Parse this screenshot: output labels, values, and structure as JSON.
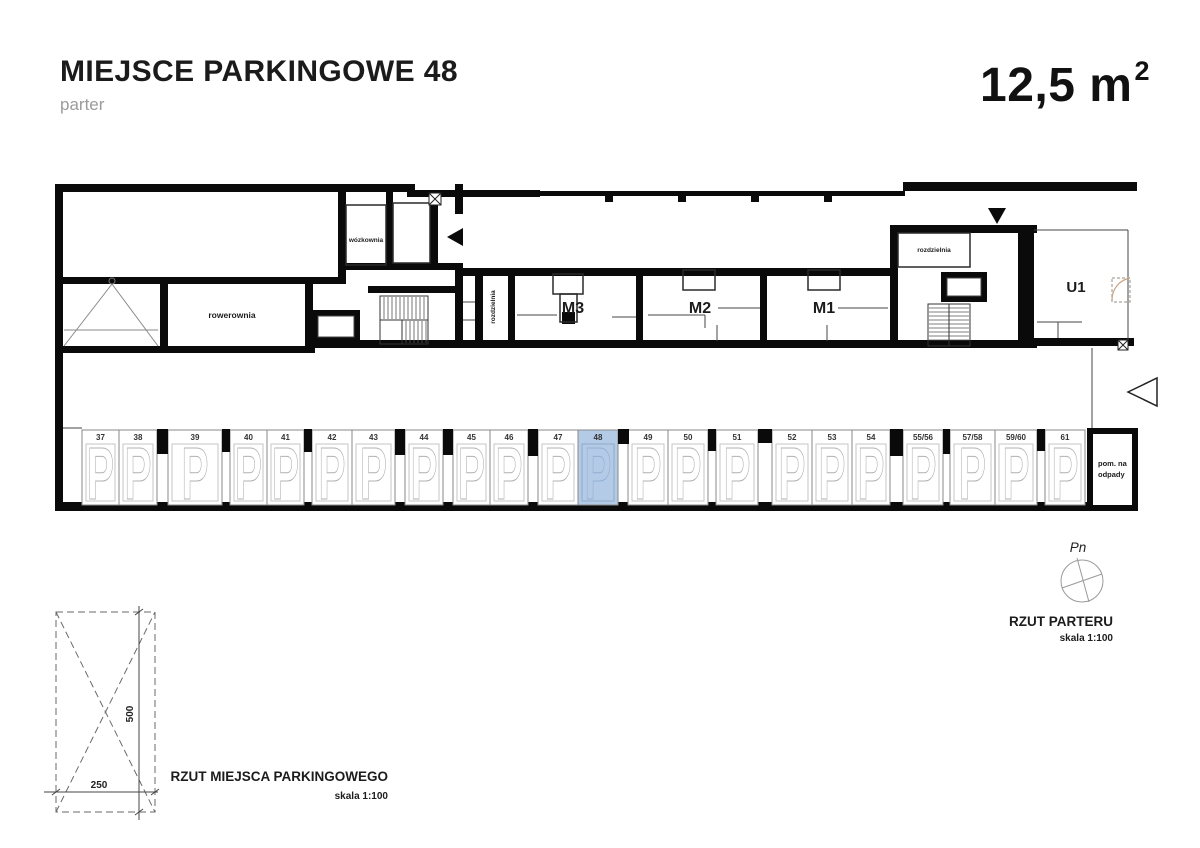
{
  "header": {
    "title": "MIEJSCE PARKINGOWE 48",
    "subtitle": "parter",
    "area": "12,5 m",
    "area_exponent": "2"
  },
  "plan": {
    "rooms": {
      "rowerownia": "rowerownia",
      "wozkownia": "wózkownia",
      "rozdzielnia_left": "rozdzielnia",
      "m3": "M3",
      "m2": "M2",
      "m1": "M1",
      "rozdzielnia_right": "rozdzielnia",
      "u1": "U1",
      "waste_room_line1": "pom. na",
      "waste_room_line2": "odpady"
    }
  },
  "parking": {
    "highlighted_space": "48",
    "space_marker": "P",
    "colors": {
      "highlight_fill": "#b3cbe7",
      "highlight_inner_stroke": "#8da8c9",
      "highlight_p_stroke": "#93afd2",
      "stall_stroke": "#8a8a8a",
      "inner_stroke": "#c6c6c6",
      "p_stroke": "#b2b2b2",
      "number_color": "#333333",
      "pillar_fill": "#0a0a0a"
    },
    "spaces": [
      {
        "label": "37",
        "x": 82,
        "w": 37
      },
      {
        "label": "38",
        "x": 119,
        "w": 38
      },
      {
        "label": "39",
        "x": 168,
        "w": 54
      },
      {
        "label": "40",
        "x": 230,
        "w": 37
      },
      {
        "label": "41",
        "x": 267,
        "w": 37
      },
      {
        "label": "42",
        "x": 312,
        "w": 40
      },
      {
        "label": "43",
        "x": 352,
        "w": 43
      },
      {
        "label": "44",
        "x": 405,
        "w": 38
      },
      {
        "label": "45",
        "x": 453,
        "w": 37
      },
      {
        "label": "46",
        "x": 490,
        "w": 38
      },
      {
        "label": "47",
        "x": 538,
        "w": 40
      },
      {
        "label": "48",
        "x": 578,
        "w": 40
      },
      {
        "label": "49",
        "x": 628,
        "w": 40
      },
      {
        "label": "50",
        "x": 668,
        "w": 40
      },
      {
        "label": "51",
        "x": 716,
        "w": 42
      },
      {
        "label": "52",
        "x": 772,
        "w": 40
      },
      {
        "label": "53",
        "x": 812,
        "w": 40
      },
      {
        "label": "54",
        "x": 852,
        "w": 38
      },
      {
        "label": "55/56",
        "x": 903,
        "w": 40
      },
      {
        "label": "57/58",
        "x": 950,
        "w": 45
      },
      {
        "label": "59/60",
        "x": 995,
        "w": 42
      },
      {
        "label": "61",
        "x": 1045,
        "w": 40
      }
    ],
    "pillars": [
      {
        "x": 157,
        "w": 11,
        "h": 25
      },
      {
        "x": 222,
        "w": 8,
        "h": 23
      },
      {
        "x": 304,
        "w": 8,
        "h": 23
      },
      {
        "x": 395,
        "w": 10,
        "h": 26
      },
      {
        "x": 443,
        "w": 10,
        "h": 26
      },
      {
        "x": 528,
        "w": 10,
        "h": 27
      },
      {
        "x": 618,
        "w": 11,
        "h": 15
      },
      {
        "x": 708,
        "w": 8,
        "h": 22
      },
      {
        "x": 758,
        "w": 14,
        "h": 14
      },
      {
        "x": 890,
        "w": 13,
        "h": 27
      },
      {
        "x": 943,
        "w": 7,
        "h": 25
      },
      {
        "x": 1037,
        "w": 8,
        "h": 22
      }
    ]
  },
  "compass": {
    "north": "Pn"
  },
  "plan_caption": {
    "title": "RZUT PARTERU",
    "scale": "skala 1:100"
  },
  "stall_caption": {
    "title": "RZUT MIEJSCA PARKINGOWEGO",
    "scale": "skala 1:100",
    "width_dim": "250",
    "depth_dim": "500"
  }
}
